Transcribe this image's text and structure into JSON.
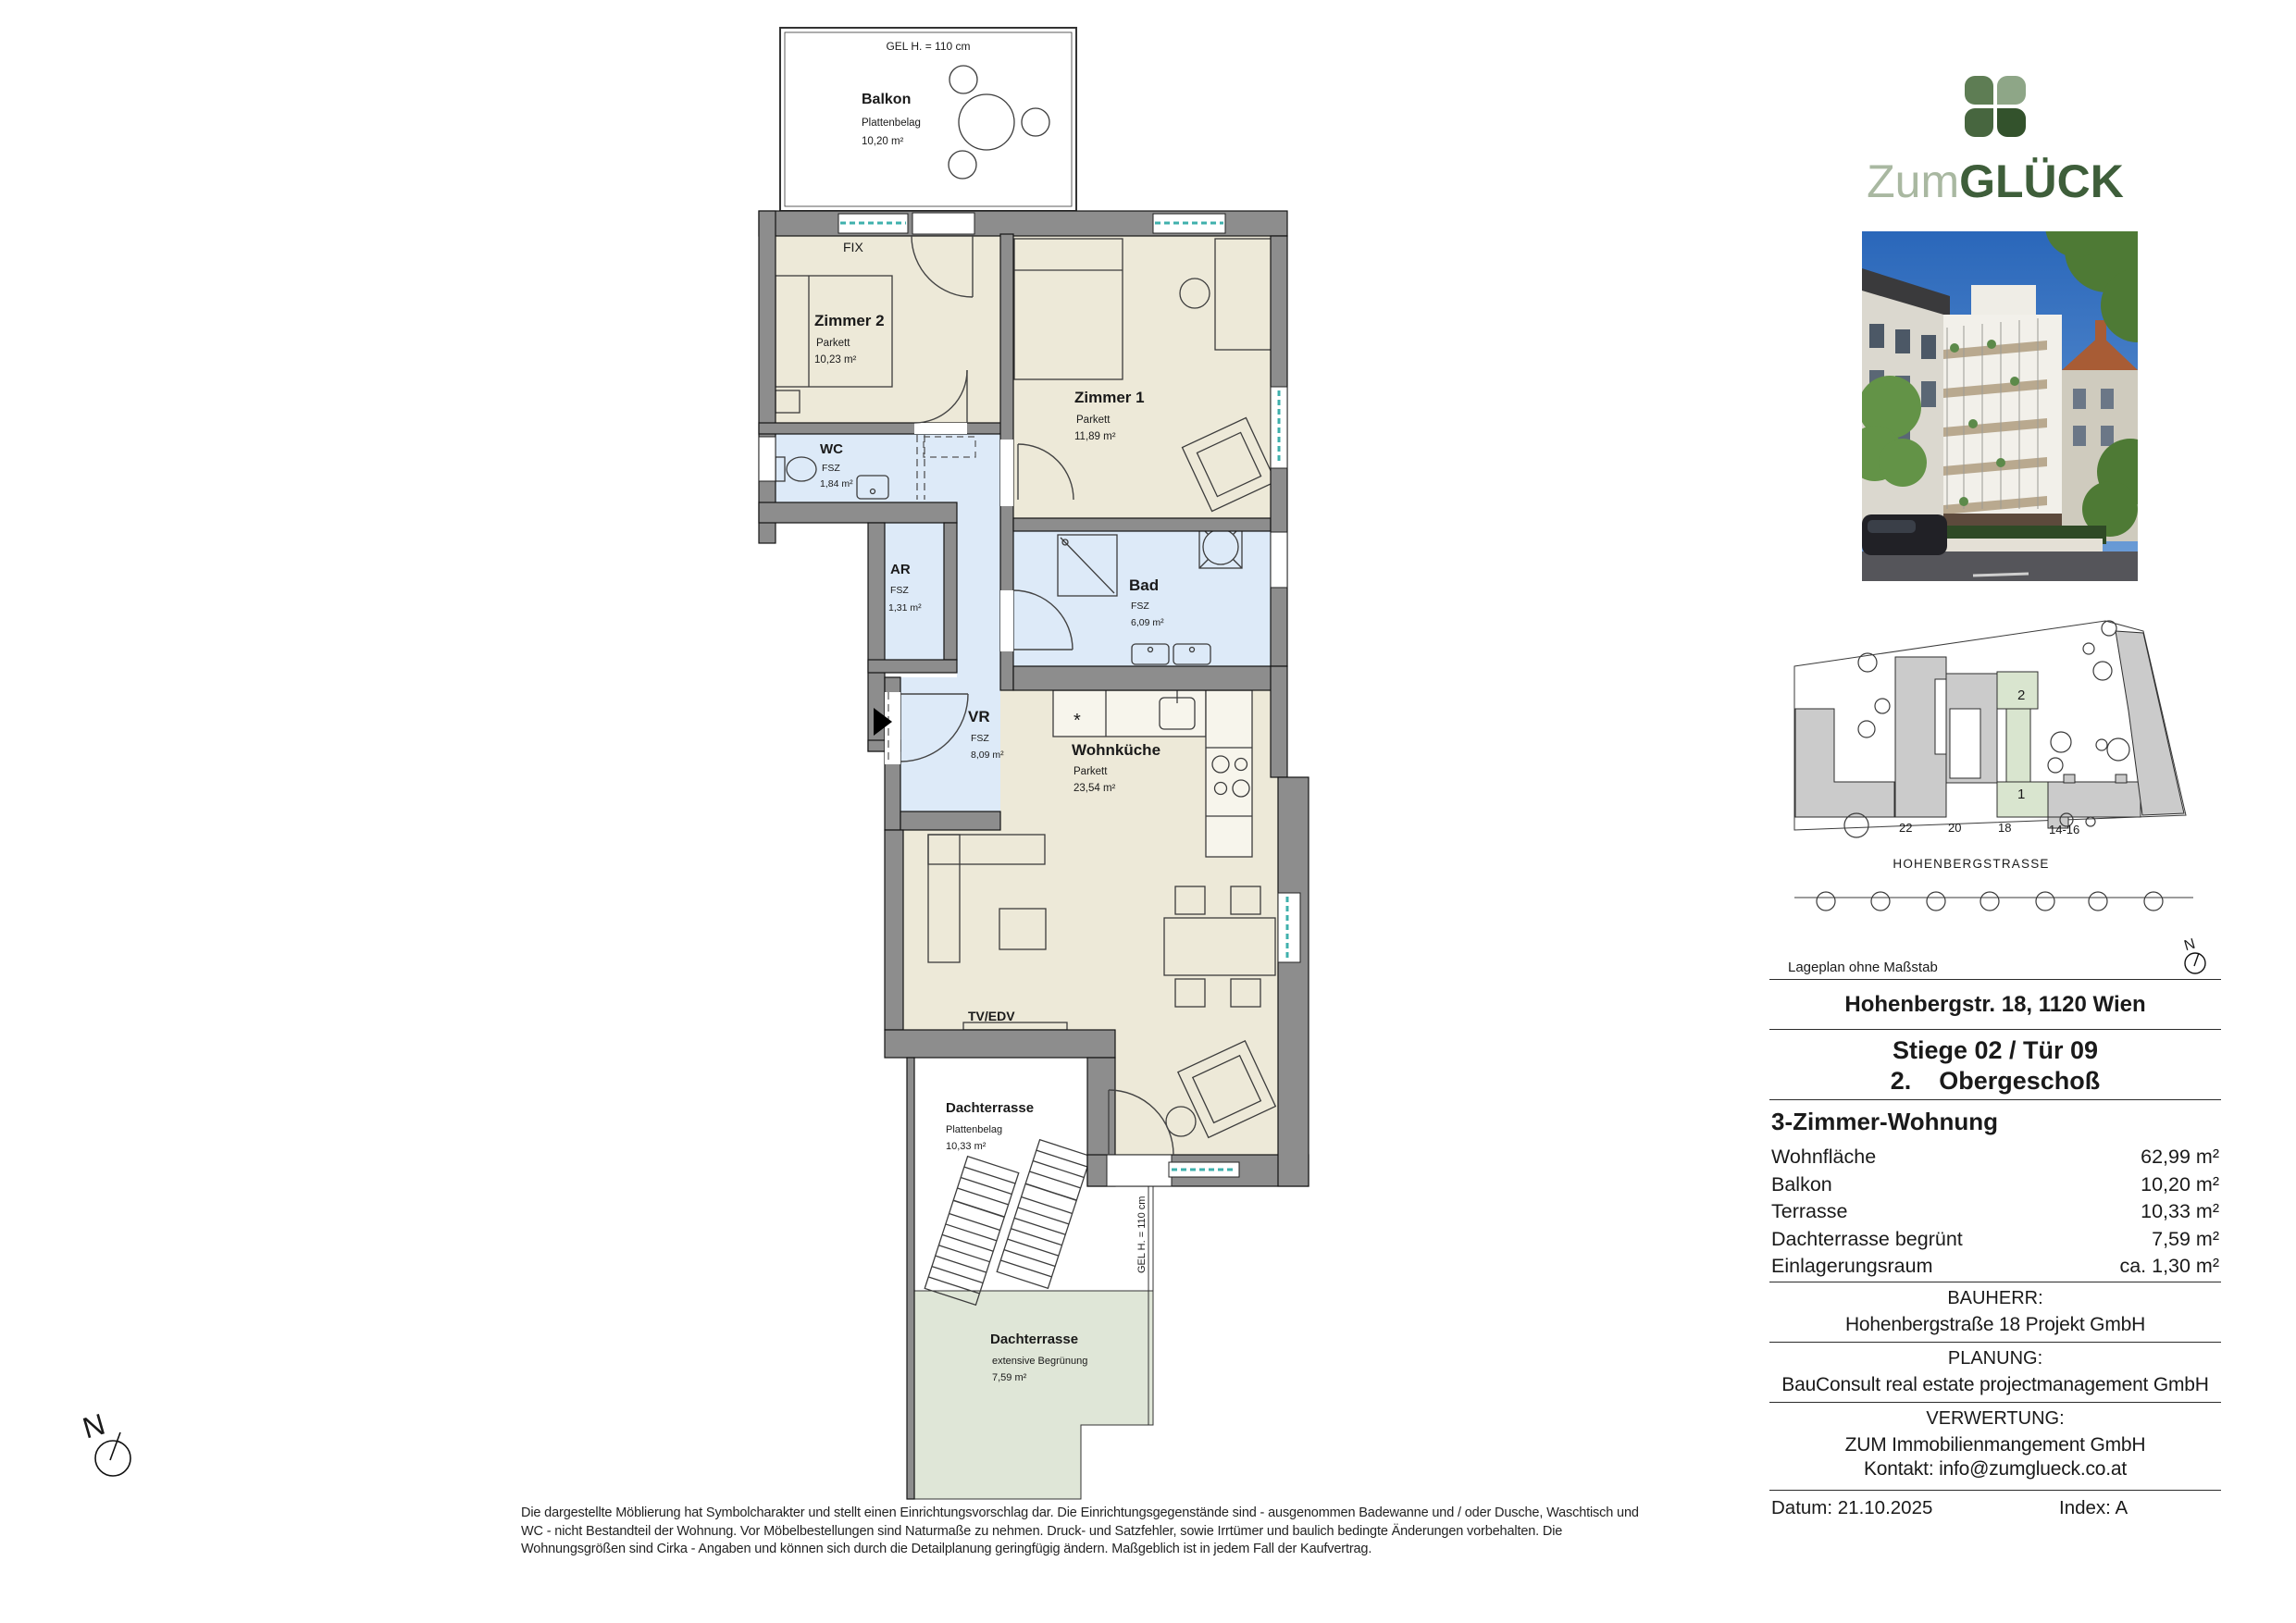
{
  "brand": {
    "prefix": "Zum",
    "suffix": "GLÜCK",
    "prefix_color": "#a9b8a1",
    "suffix_color": "#3e5e3a",
    "clover_colors": {
      "top_left": "#5e7d54",
      "top_right": "#8ea687",
      "bottom_left": "#47663f",
      "bottom_right": "#33522c"
    }
  },
  "plan": {
    "annotations": {
      "gel_balkon": "GEL H. = 110 cm",
      "gel_terrasse": "GEL H. = 110 cm",
      "fix": "FIX",
      "tv": "TV/EDV",
      "north": "N"
    },
    "rooms": {
      "balkon": {
        "name": "Balkon",
        "finish": "Plattenbelag",
        "area": "10,20 m²"
      },
      "zimmer2": {
        "name": "Zimmer 2",
        "finish": "Parkett",
        "area": "10,23 m²"
      },
      "zimmer1": {
        "name": "Zimmer 1",
        "finish": "Parkett",
        "area": "11,89 m²"
      },
      "wc": {
        "name": "WC",
        "finish": "FSZ",
        "area": "1,84 m²"
      },
      "ar": {
        "name": "AR",
        "finish": "FSZ",
        "area": "1,31 m²"
      },
      "bad": {
        "name": "Bad",
        "finish": "FSZ",
        "area": "6,09 m²"
      },
      "vr": {
        "name": "VR",
        "finish": "FSZ",
        "area": "8,09 m²"
      },
      "wohnkueche": {
        "name": "Wohnküche",
        "finish": "Parkett",
        "area": "23,54 m²"
      },
      "terrasse": {
        "name": "Dachterrasse",
        "finish": "Plattenbelag",
        "area": "10,33 m²"
      },
      "gruendach": {
        "name": "Dachterrasse",
        "finish": "extensive Begrünung",
        "area": "7,59 m²"
      }
    }
  },
  "site_plan": {
    "caption": "Lageplan ohne Maßstab",
    "street_name": "HOHENBERGSTRASSE",
    "house_numbers": [
      "22",
      "20",
      "18",
      "14-16"
    ],
    "unit_markers": [
      "2",
      "1"
    ],
    "north": "N"
  },
  "info": {
    "address": "Hohenbergstr. 18, 1120 Wien",
    "stiege": "Stiege 02 / Tür 09",
    "floor_line": "2.    Obergeschoß",
    "unit_type": "3-Zimmer-Wohnung",
    "areas": [
      {
        "label": "Wohnfläche",
        "value": "62,99 m²"
      },
      {
        "label": "Balkon",
        "value": "10,20 m²"
      },
      {
        "label": "Terrasse",
        "value": "10,33 m²"
      },
      {
        "label": "Dachterrasse begrünt",
        "value": "7,59 m²"
      },
      {
        "label": "Einlagerungsraum",
        "value": "ca. 1,30 m²"
      }
    ],
    "bauherr_heading": "BAUHERR:",
    "bauherr": "Hohenbergstraße 18 Projekt GmbH",
    "planung_heading": "PLANUNG:",
    "planung": "BauConsult real estate projectmanagement GmbH",
    "verwertung_heading": "VERWERTUNG:",
    "verwertung_line1": "ZUM Immobilienmangement GmbH",
    "verwertung_line2": "Kontakt: info@zumglueck.co.at",
    "datum_label": "Datum:",
    "datum_value": "21.10.2025",
    "index_label": "Index:",
    "index_value": "A"
  },
  "footer": {
    "lines": [
      "Die dargestellte Möblierung hat Symbolcharakter und stellt einen Einrichtungsvorschlag dar. Die Einrichtungsgegenstände sind - ausgenommen Badewanne und / oder Dusche, Waschtisch und",
      "WC - nicht Bestandteil der Wohnung. Vor Möbelbestellungen sind Naturmaße zu nehmen. Druck- und Satzfehler, sowie Irrtümer und baulich bedingte Änderungen vorbehalten. Die",
      "Wohnungsgrößen sind Cirka - Angaben und können sich durch die Detailplanung geringfügig ändern. Maßgeblich ist in jedem Fall der Kaufvertrag."
    ]
  },
  "colors": {
    "wall": "#8d8d8d",
    "parkett": "#EDE9D8",
    "fsz": "#DDEAF8",
    "terrace_green": "#DFE6D7",
    "site_green": "#D9E5CF",
    "site_gray": "#CBCBCB",
    "window_glass": "#3FB0AC"
  }
}
